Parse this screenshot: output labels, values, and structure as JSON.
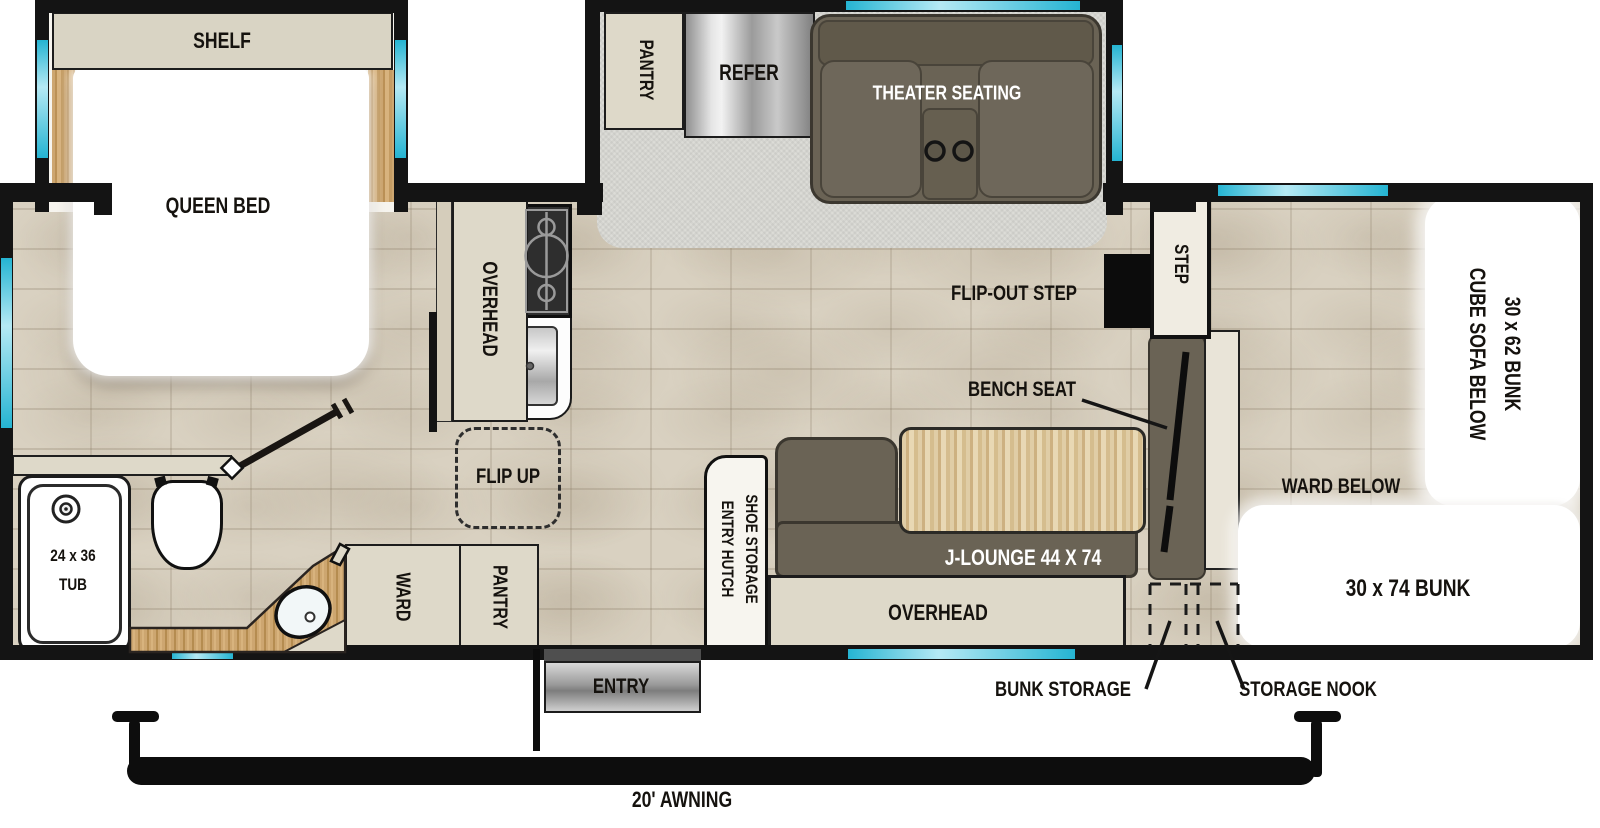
{
  "title": "Travel trailer floor plan",
  "colors": {
    "wall": "#141414",
    "window_cyan": "#25b4d2",
    "tile_floor": "#d9d1c1",
    "carpet": "#dcdcd7",
    "cabinet_beige": "#ded9c9",
    "sofa_olive": "#6a6355",
    "wood": "#c9a26c",
    "table_wood": "#d8c49c",
    "fixture_white": "#ffffff"
  },
  "bedroom": {
    "shelf": "SHELF",
    "queen_bed": "QUEEN BED"
  },
  "slide_out": {
    "pantry": "PANTRY",
    "refer": "REFER",
    "theater_seating": "THEATER SEATING"
  },
  "kitchen": {
    "overhead": "OVERHEAD",
    "flip_up": "FLIP UP"
  },
  "bathroom": {
    "tub_size": "24 x 36",
    "tub": "TUB",
    "ward": "WARD",
    "pantry": "PANTRY"
  },
  "living": {
    "flip_out_step": "FLIP-OUT STEP",
    "step": "STEP",
    "bench_seat": "BENCH SEAT",
    "j_lounge": "J-LOUNGE 44 X 74",
    "overhead": "OVERHEAD",
    "entry_hutch": "ENTRY HUTCH",
    "shoe_storage": "SHOE STORAGE"
  },
  "bunk_room": {
    "bunk_30x62": "30 x 62 BUNK",
    "cube_sofa_below": "CUBE SOFA BELOW",
    "ward_below": "WARD BELOW",
    "bunk_30x74": "30 x 74 BUNK",
    "bunk_storage": "BUNK STORAGE",
    "storage_nook": "STORAGE NOOK"
  },
  "exterior": {
    "entry": "ENTRY",
    "awning": "20' AWNING"
  }
}
